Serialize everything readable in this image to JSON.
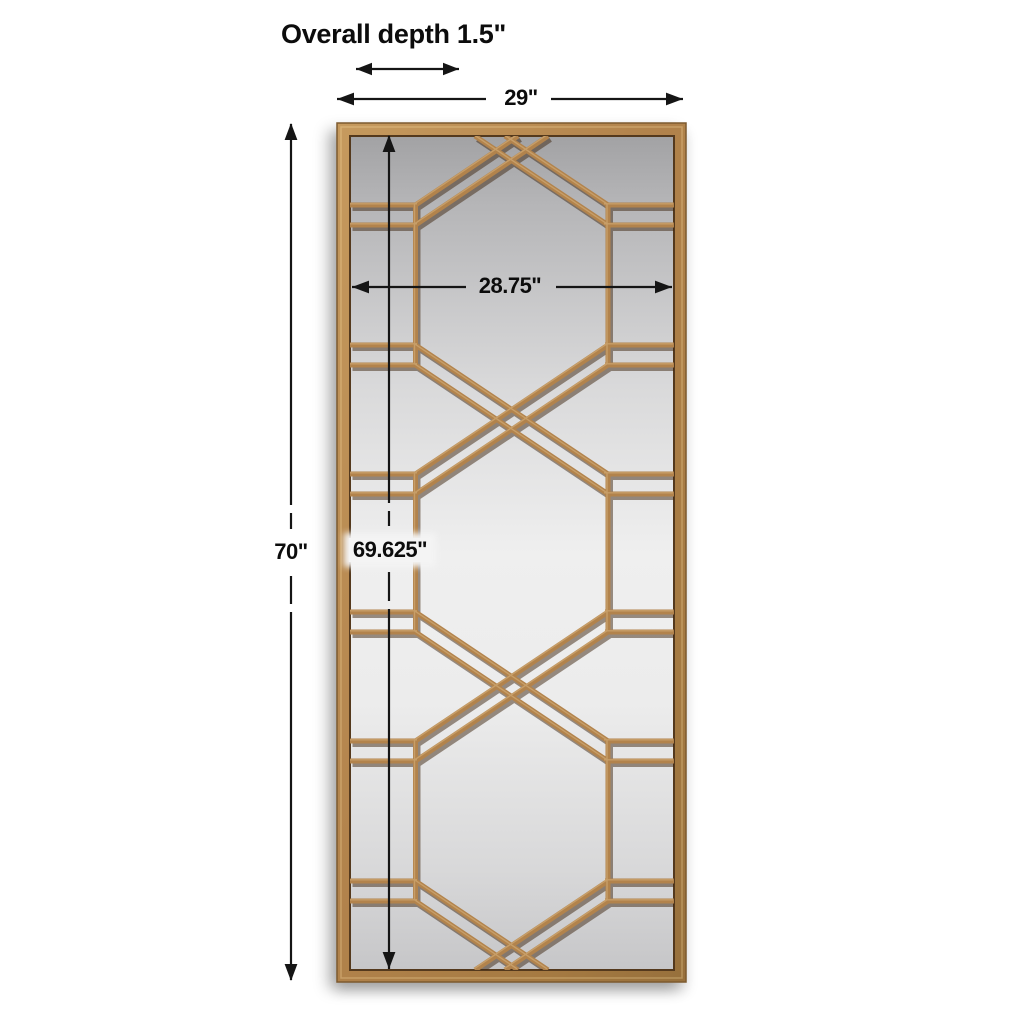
{
  "diagram": {
    "background_color": "#ffffff",
    "annotations": {
      "overall_depth": "Overall depth 1.5\"",
      "outer_width": "29\"",
      "inner_width": "28.75\"",
      "outer_height": "70\"",
      "inner_height": "69.625\""
    },
    "colors": {
      "frame_gold": "#b2834c",
      "frame_gold_light": "#c69a5e",
      "frame_gold_dark": "#7d5a2f",
      "fretwork_gold": "#b2834c",
      "fretwork_shadow": "rgba(61,38,16,0.5)",
      "mirror_glass_light": "#efefef",
      "mirror_glass_dark": "#a2a2a4",
      "dimension_line": "#151515",
      "label_text": "#0c0c0c"
    }
  }
}
